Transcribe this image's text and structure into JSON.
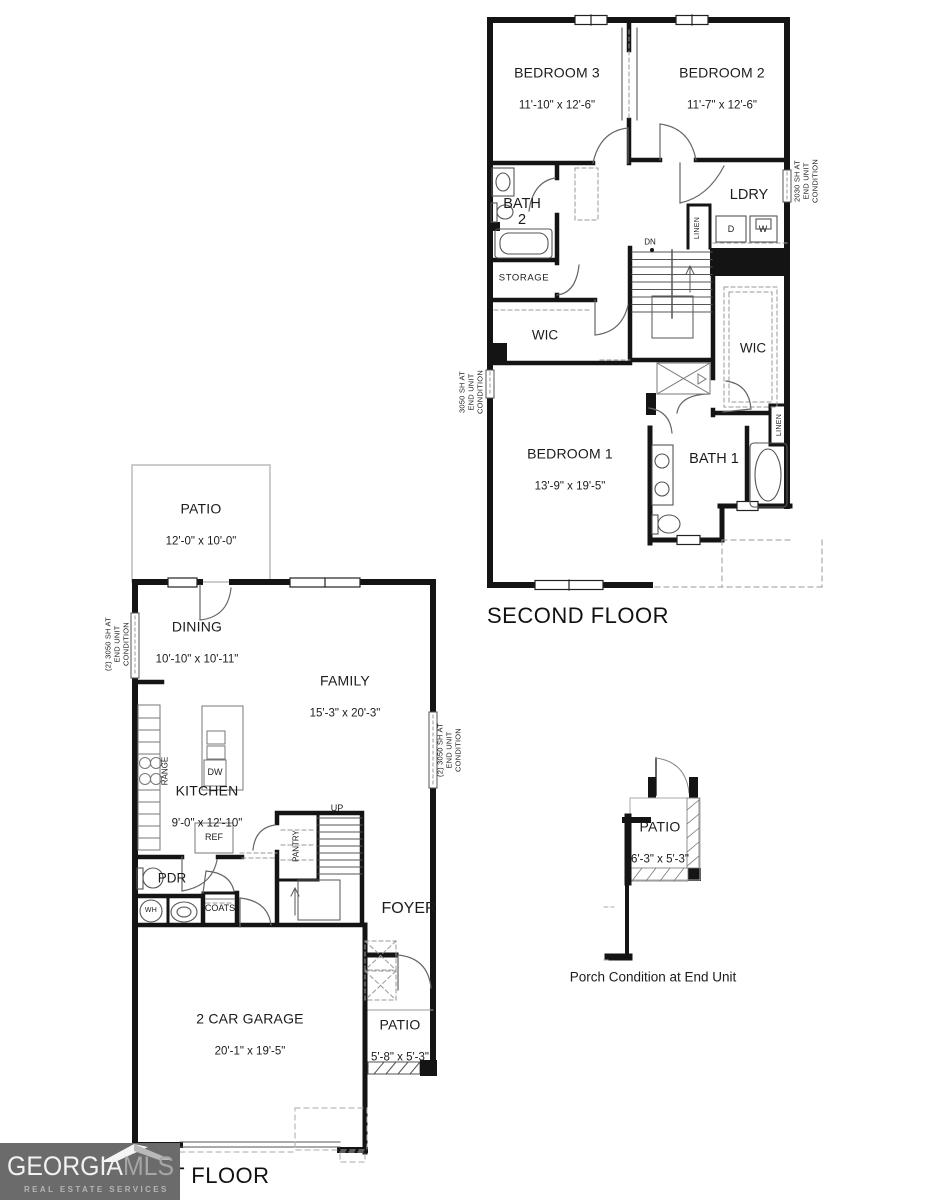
{
  "second_floor": {
    "title": "SECOND FLOOR",
    "rooms": {
      "bedroom3": {
        "name": "BEDROOM 3",
        "dims": "11'-10\" x 12'-6\""
      },
      "bedroom2": {
        "name": "BEDROOM 2",
        "dims": "11'-7\" x 12'-6\""
      },
      "bedroom1": {
        "name": "BEDROOM 1",
        "dims": "13'-9\" x 19'-5\""
      },
      "bath2": "BATH\n2",
      "bath1": "BATH 1",
      "laundry": "LDRY",
      "storage": "STORAGE",
      "wic_left": "WIC",
      "wic_right": "WIC",
      "linen_hall": "LINEN",
      "linen_bath": "LINEN"
    },
    "stairs": {
      "down": "DN"
    },
    "appliances": {
      "dryer": "D",
      "washer": "W"
    },
    "window_note_left": "3050 SH AT\nEND UNIT\nCONDITION",
    "window_note_right": "2030 SH AT\nEND UNIT\nCONDITION"
  },
  "first_floor": {
    "title": "FIRST FLOOR",
    "rooms": {
      "patio_rear": {
        "name": "PATIO",
        "dims": "12'-0\" x 10'-0\""
      },
      "dining": {
        "name": "DINING",
        "dims": "10'-10\" x 10'-11\""
      },
      "family": {
        "name": "FAMILY",
        "dims": "15'-3\" x 20'-3\""
      },
      "kitchen": {
        "name": "KITCHEN",
        "dims": "9'-0\" x 12'-10\""
      },
      "garage": {
        "name": "2 CAR GARAGE",
        "dims": "20'-1\" x 19'-5\""
      },
      "patio_front": {
        "name": "PATIO",
        "dims": "5'-8\" x 5'-3\""
      },
      "powder": "PDR",
      "coats": "COATS",
      "foyer": "FOYER",
      "pantry": "PANTRY"
    },
    "fixtures": {
      "range": "RANGE",
      "dishwasher": "DW",
      "refrigerator": "REF",
      "water_heater": "WH"
    },
    "stairs": {
      "up": "UP"
    },
    "window_note_left": "(2) 3050 SH AT\nEND UNIT\nCONDITION",
    "window_note_right": "(2) 3050 SH AT\nEND UNIT\nCONDITION"
  },
  "porch_detail": {
    "patio": {
      "name": "PATIO",
      "dims": "6'-3\" x 5'-3\""
    },
    "caption": "Porch Condition at End Unit"
  },
  "logo": {
    "name_primary": "GEORGIA",
    "name_secondary": "MLS",
    "tagline": "REAL ESTATE SERVICES"
  }
}
